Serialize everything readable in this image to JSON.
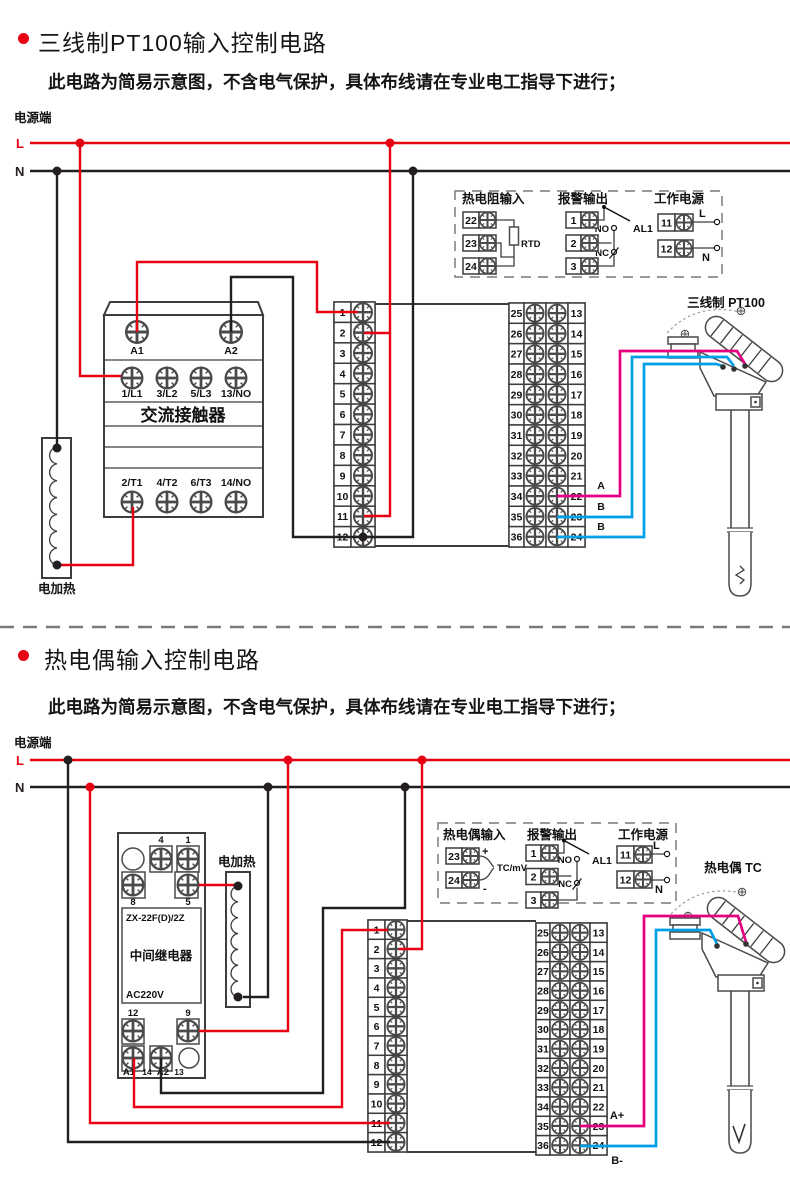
{
  "section1": {
    "title": "三线制PT100输入控制电路",
    "subtitle": "此电路为简易示意图，不含电气保护，具体布线请在专业电工指导下进行；",
    "power_label": "电源端",
    "l": "L",
    "n": "N",
    "contactor": {
      "a1": "A1",
      "a2": "A2",
      "row_top": [
        "1/L1",
        "3/L2",
        "5/L3",
        "13/NO"
      ],
      "name": "交流接触器",
      "row_bottom": [
        "2/T1",
        "4/T2",
        "6/T3",
        "14/NO"
      ]
    },
    "heater": "电加热",
    "sensor": "三线制 PT100",
    "wire_a": "A",
    "wire_b1": "B",
    "wire_b2": "B",
    "legend": {
      "input_title": "热电阻输入",
      "rtd": "RTD",
      "alarm_title": "报警输出",
      "no": "NO",
      "nc": "NC",
      "al1": "AL1",
      "power_title": "工作电源",
      "l": "L",
      "n": "N",
      "input_terminals": [
        "22",
        "23",
        "24"
      ],
      "alarm_terminals": [
        "1",
        "2",
        "3"
      ],
      "power_terminals": [
        "11",
        "12"
      ]
    }
  },
  "section2": {
    "title": "热电偶输入控制电路",
    "subtitle": "此电路为简易示意图，不含电气保护，具体布线请在专业电工指导下进行；",
    "power_label": "电源端",
    "l": "L",
    "n": "N",
    "relay": {
      "t4": "4",
      "t1": "1",
      "t8": "8",
      "t5": "5",
      "model": "ZX-22F(D)/2Z",
      "name": "中间继电器",
      "voltage": "AC220V",
      "t12": "12",
      "t9": "9",
      "ta1": "A1",
      "t14": "14",
      "ta2": "A2",
      "t13": "13"
    },
    "heater": "电加热",
    "sensor": "热电偶 TC",
    "wire_a": "A+",
    "wire_b": "B-",
    "legend": {
      "input_title": "热电偶输入",
      "plus": "+",
      "minus": "-",
      "tcmv": "TC/mV",
      "alarm_title": "报警输出",
      "no": "NO",
      "nc": "NC",
      "al1": "AL1",
      "power_title": "工作电源",
      "l": "L",
      "n": "N",
      "input_terminals": [
        "23",
        "24"
      ],
      "alarm_terminals": [
        "1",
        "2",
        "3"
      ],
      "power_terminals": [
        "11",
        "12"
      ]
    }
  },
  "terminals": {
    "mid": [
      "1",
      "2",
      "3",
      "4",
      "5",
      "6",
      "7",
      "8",
      "9",
      "10",
      "11",
      "12"
    ],
    "left": [
      "25",
      "26",
      "27",
      "28",
      "29",
      "30",
      "31",
      "32",
      "33",
      "34",
      "35",
      "36"
    ],
    "right": [
      "13",
      "14",
      "15",
      "16",
      "17",
      "18",
      "19",
      "20",
      "21",
      "22",
      "23",
      "24"
    ]
  },
  "colors": {
    "red": "#e60012",
    "black": "#231f20",
    "magenta": "#e4007f",
    "blue": "#00a0e9"
  }
}
